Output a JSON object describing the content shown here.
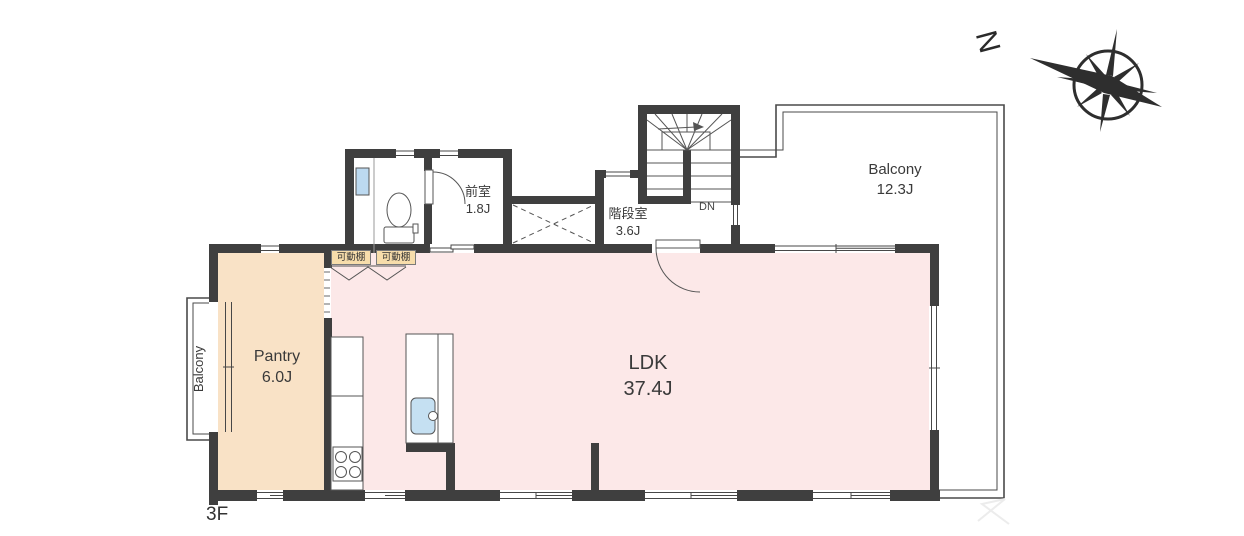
{
  "floor_label": "3F",
  "compass": {
    "north_label": "N"
  },
  "rooms": {
    "ldk": {
      "name": "LDK",
      "size": "37.4J"
    },
    "pantry": {
      "name": "Pantry",
      "size": "6.0J"
    },
    "anteroom": {
      "name": "前室",
      "size": "1.8J"
    },
    "stairwell": {
      "name": "階段室",
      "size": "3.6J"
    },
    "balcony_right": {
      "name": "Balcony",
      "size": "12.3J"
    },
    "balcony_left": {
      "name": "Balcony"
    }
  },
  "annotations": {
    "stairs_down": "DN",
    "movable_shelf_1": "可動棚",
    "movable_shelf_2": "可動棚"
  },
  "colors": {
    "wall": "#3f3f3f",
    "ldk_fill": "#fce8e8",
    "pantry_fill": "#f9e2c6",
    "shelf_label_bg": "#f7ddab",
    "window_glass": "#bcd9f0",
    "sink": "#c5e0f2",
    "outline": "#4a4a4a"
  }
}
